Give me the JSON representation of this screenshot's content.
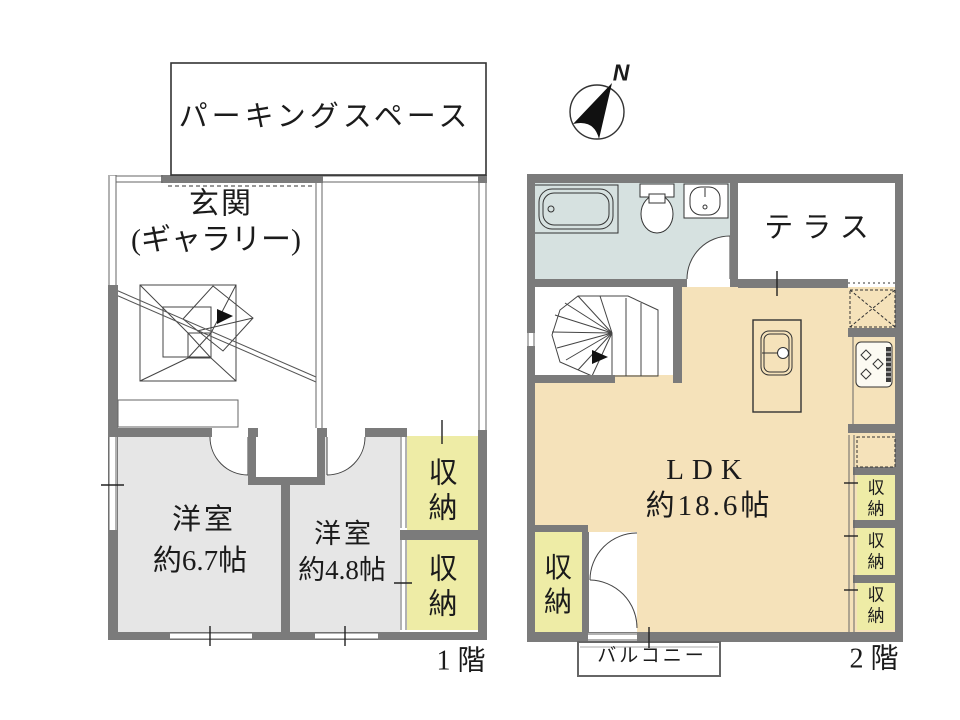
{
  "compass": {
    "north": "N"
  },
  "floor1": {
    "label": "1 階",
    "parking_label": "パーキングスペース",
    "entrance_name": "玄関",
    "entrance_sub": "(ギャラリー)",
    "room1": {
      "name": "洋室",
      "size": "約6.7帖"
    },
    "room2": {
      "name": "洋室",
      "size": "約4.8帖"
    },
    "storage_upper": "収納",
    "storage_lower": "収納"
  },
  "floor2": {
    "label": "2 階",
    "terrace_label": "テラス",
    "ldk": {
      "name": "LDK",
      "size": "約18.6帖"
    },
    "storage_left": "収納",
    "storage_right": [
      {
        "label": "収納"
      },
      {
        "label": "収納"
      },
      {
        "label": "収納"
      }
    ],
    "balcony_label": "バルコニー"
  },
  "colors": {
    "wall": "#7b7b7b",
    "room_floor": "#e6e6e6",
    "storage_fill": "#eeecA6",
    "ldk_floor": "#f5e2ba",
    "bath_floor": "#d6e1e0"
  }
}
